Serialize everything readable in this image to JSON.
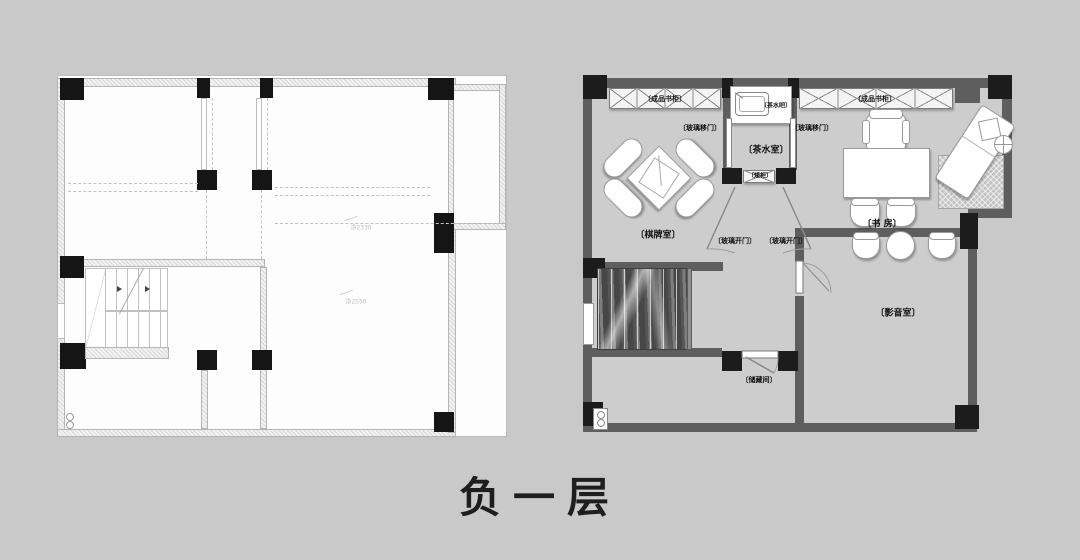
{
  "page": {
    "title": "负一层"
  },
  "left_plan": {
    "annotations": {
      "beam_upper": "净2330",
      "beam_lower": "净2550"
    }
  },
  "right_plan": {
    "labels": {
      "chess_room": "〔棋牌室〕",
      "tea_room": "〔茶水室〕",
      "study": "〔书 房〕",
      "media_room": "〔影音室〕",
      "storage_room": "〔储藏间〕",
      "bookcase_left": "〔成品书柜〕",
      "bookcase_right": "〔成品书柜〕",
      "tea_bar": "〔茶水吧〕",
      "sliding_door_left": "〔玻璃移门〕",
      "sliding_door_right": "〔玻璃移门〕",
      "low_cabinet": "〔矮柜〕",
      "glass_door_left": "〔玻璃开门〕",
      "glass_door_right": "〔玻璃开门〕"
    }
  },
  "colors": {
    "background": "#c9c9c9",
    "left_plan_fill": "#fdfdfd",
    "right_plan_floor": "#cdcdcd",
    "wall_dark": "#5e5e5e",
    "column_black": "#1c1c1c",
    "label_text": "#111111"
  }
}
